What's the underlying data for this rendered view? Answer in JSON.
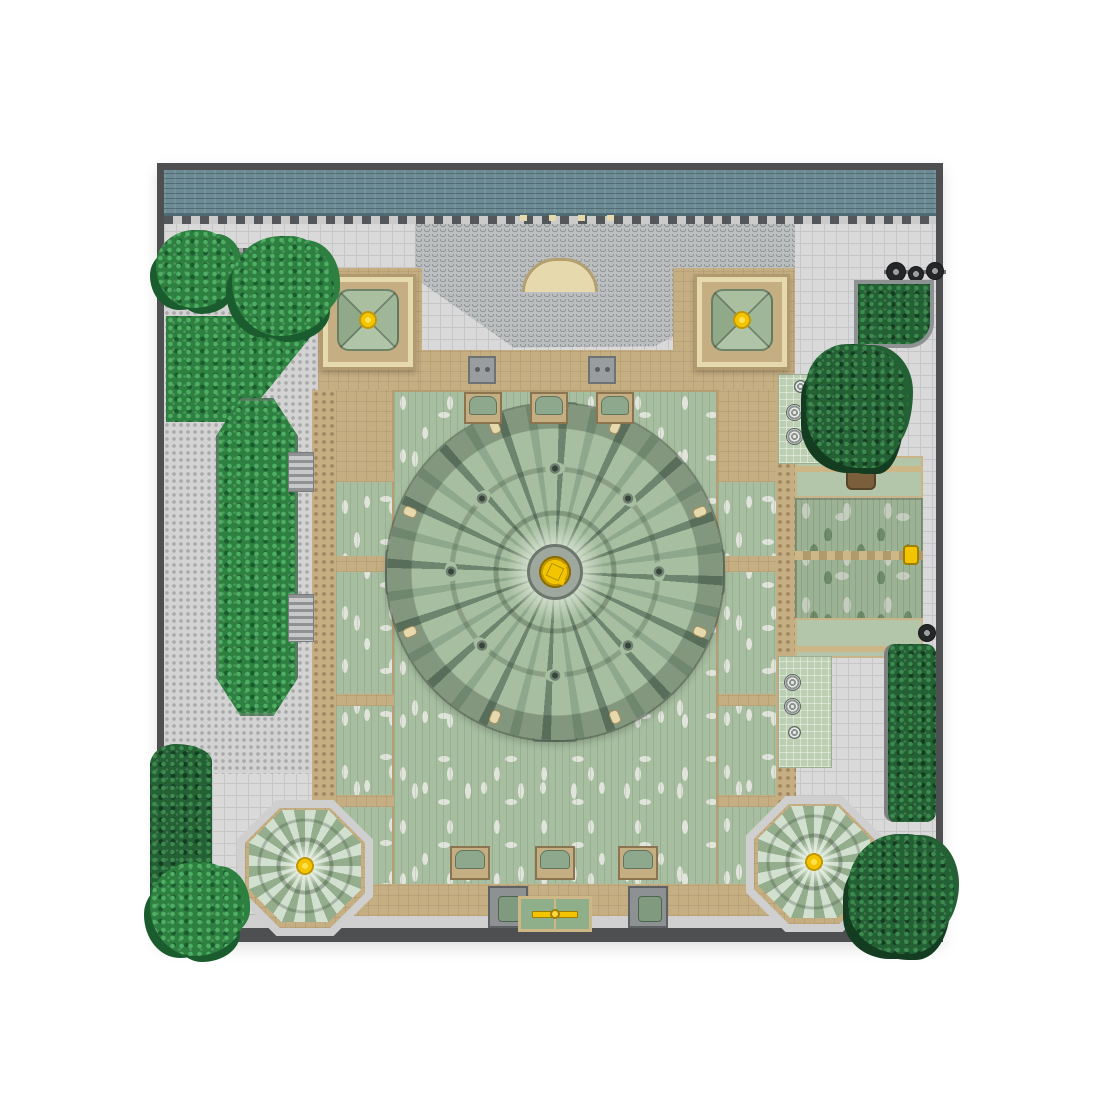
{
  "palette": {
    "basewhite": "#ffffff",
    "frame": "#4d4f51",
    "teal": "#6d8b94",
    "plaza": "#d9d9d9",
    "plazaline": "#c6c6c6",
    "stud": "#aaaaaa",
    "tan": "#c6ae83",
    "tandark": "#ad9468",
    "cream": "#e7d9ae",
    "gold": "#cdb787",
    "sage": "#a7bea0",
    "sagedark": "#8da88c",
    "sagedeep": "#6d856f",
    "speckle": "#e0e4db",
    "mint": "#d2e0d0",
    "mottle": "#9cb294",
    "mottlelight": "#c5cdbf",
    "mottledark": "#6d8a69",
    "foliage": "#2e8040",
    "foliagelight": "#4fae63",
    "foliagedark": "#1b5c2f",
    "ivy": "#236034",
    "ivydark": "#143c20",
    "yellow": "#f3c500",
    "yellowdeep": "#c1980a",
    "grayroof": "#bcbfc0",
    "gategray": "#8e9192",
    "doorgreen": "#8fae8a"
  }
}
